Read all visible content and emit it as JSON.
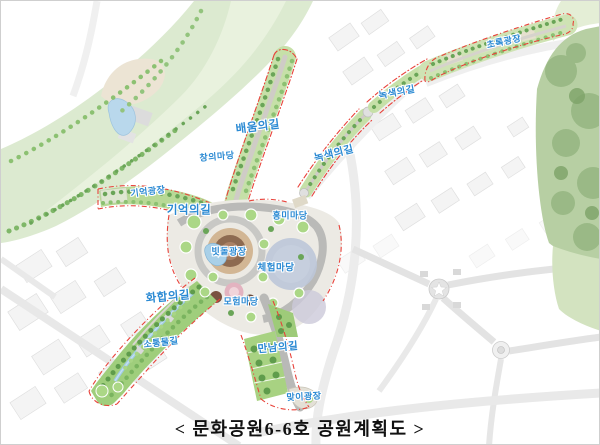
{
  "caption": {
    "text": "< 문화공원6-6호 공원계획도 >"
  },
  "map": {
    "name": "문화공원6-6호 공원계획도",
    "labels": [
      {
        "text": "초록광장"
      },
      {
        "text": "녹색의길"
      },
      {
        "text": "녹색의길"
      },
      {
        "text": "배움의길"
      },
      {
        "text": "창의마당"
      },
      {
        "text": "기억광장"
      },
      {
        "text": "기억의길"
      },
      {
        "text": "흥미마당"
      },
      {
        "text": "빗돌광장"
      },
      {
        "text": "체험마당"
      },
      {
        "text": "화합의길"
      },
      {
        "text": "모험마당"
      },
      {
        "text": "소통물길"
      },
      {
        "text": "만남의길"
      },
      {
        "text": "맞이광장"
      }
    ],
    "colors": {
      "label_blue": "#2b8ad3",
      "boundary_red": "#e8423a",
      "park_green": "#a9d585",
      "tree_green": "#6aa558",
      "forest_green": "#b7cfa3",
      "plaza_brown": "#8d6a50",
      "water_blue": "#a9d0e8",
      "experience_gray_blue": "#bcc6d8",
      "adventure_pink": "#e3b3c0",
      "caption_black": "#111111"
    }
  }
}
